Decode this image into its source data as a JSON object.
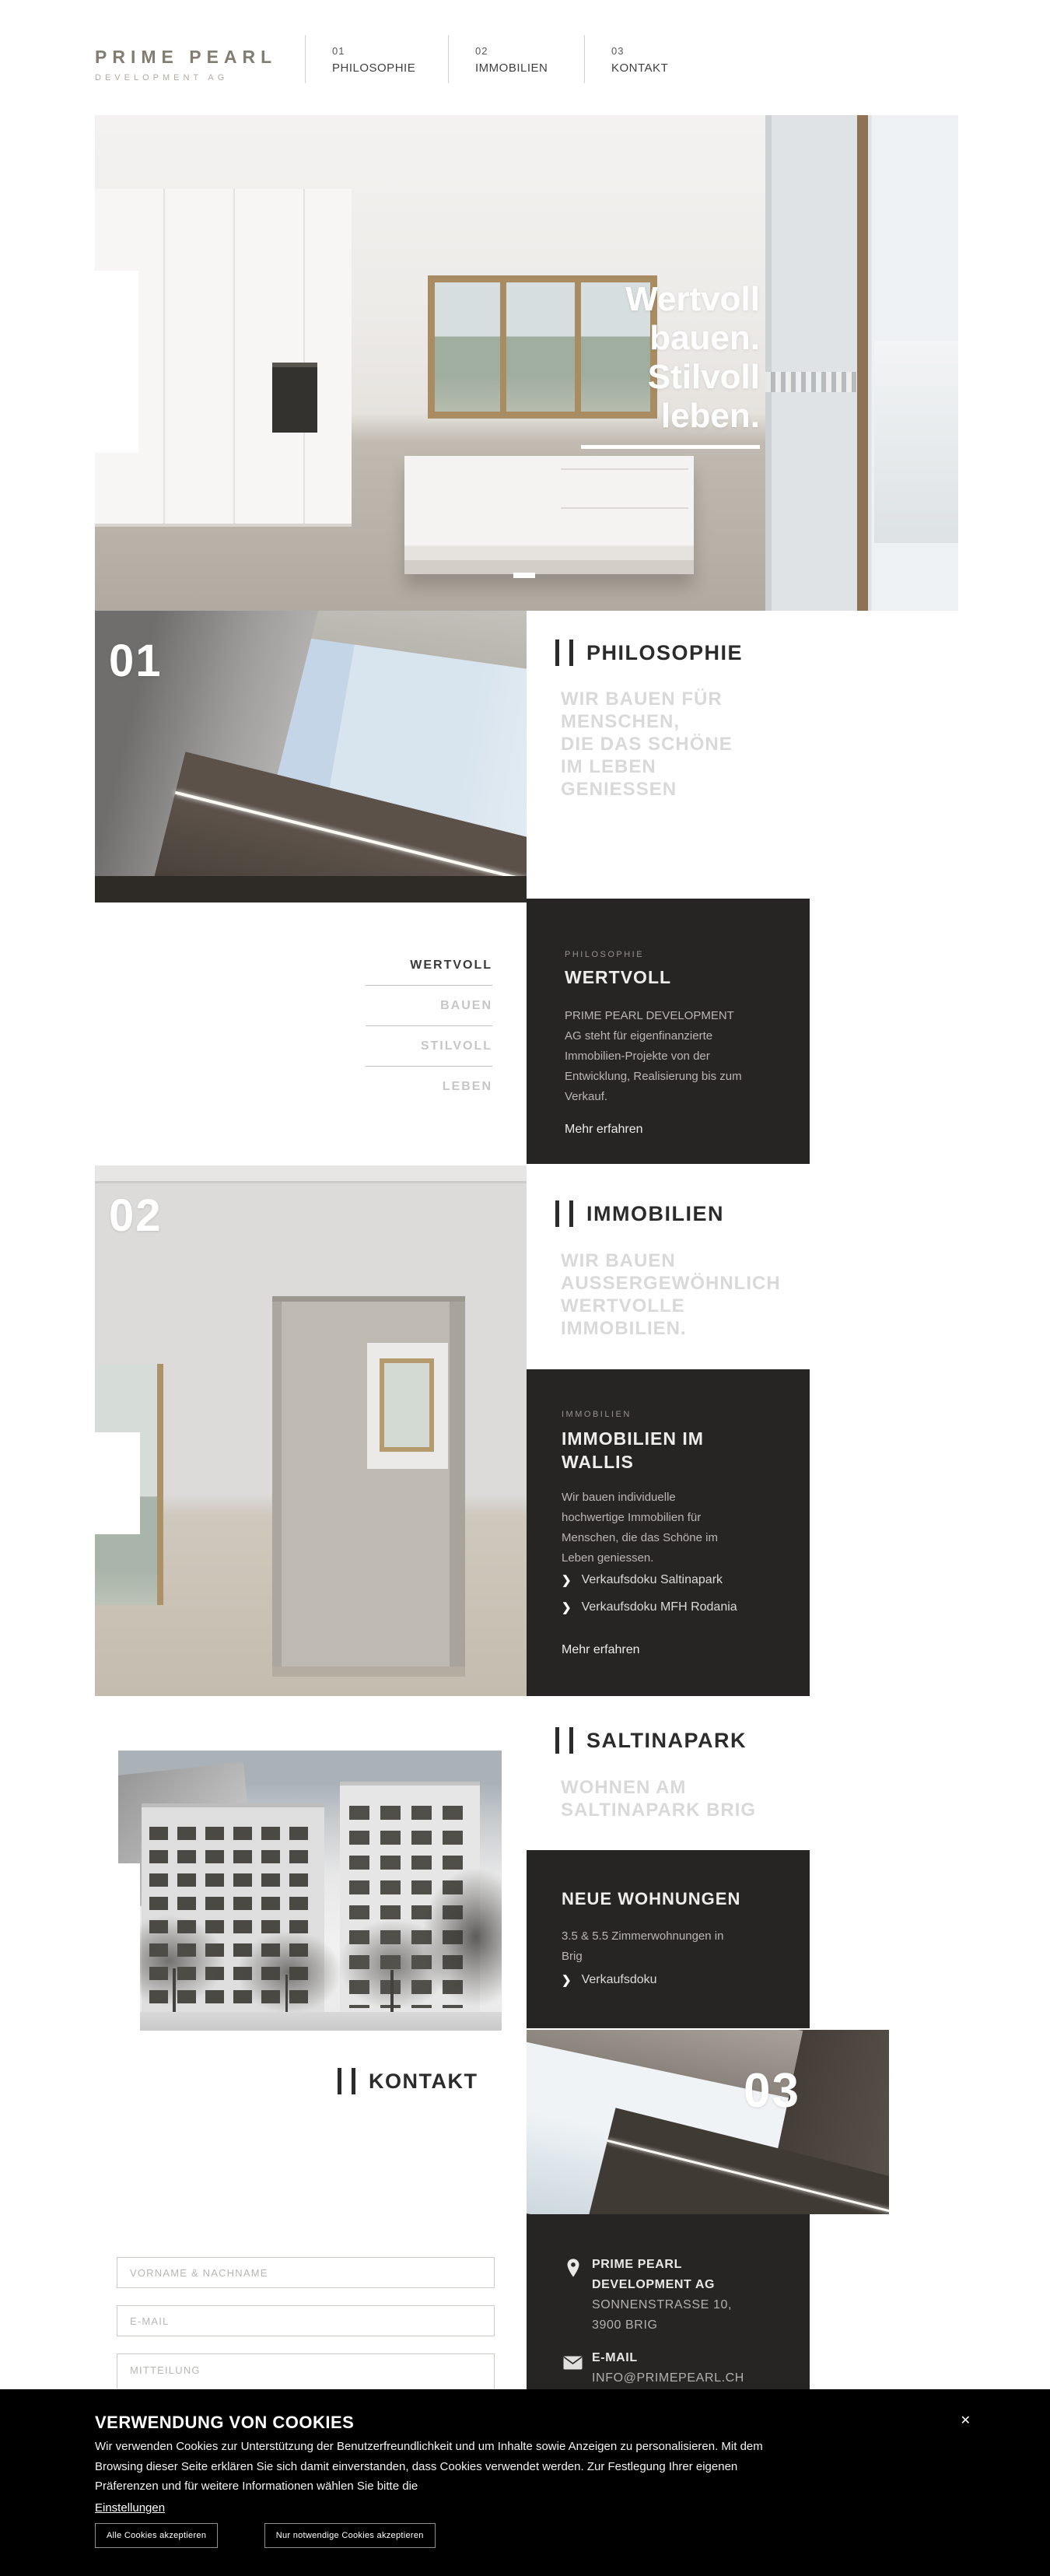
{
  "header": {
    "brand_title": "PRIME PEARL",
    "brand_subtitle": "DEVELOPMENT AG",
    "nav": [
      {
        "num": "01",
        "label": "PHILOSOPHIE"
      },
      {
        "num": "02",
        "label": "IMMOBILIEN"
      },
      {
        "num": "03",
        "label": "KONTAKT"
      }
    ]
  },
  "hero": {
    "line1": "Wertvoll",
    "line2": "bauen.",
    "line3": "Stilvoll",
    "line4": "leben."
  },
  "philosophie": {
    "number": "01",
    "heading": "PHILOSOPHIE",
    "sub1": "WIR BAUEN FÜR",
    "sub2": "MENSCHEN,",
    "sub3": "DIE DAS SCHÖNE",
    "sub4": "IM LEBEN",
    "sub5": "GENIESSEN",
    "tab1": "WERTVOLL",
    "tab2": "BAUEN",
    "tab3": "STILVOLL",
    "tab4": "LEBEN",
    "card_label": "PHILOSOPHIE",
    "card_title": "WERTVOLL",
    "card_body": "PRIME PEARL DEVELOPMENT AG steht für eigenfinanzierte Immobilien-Projekte von der Entwicklung, Realisierung bis zum Verkauf.",
    "card_link": "Mehr erfahren"
  },
  "immobilien": {
    "number": "02",
    "heading": "IMMOBILIEN",
    "sub1": "WIR BAUEN",
    "sub2": "AUSSERGEWÖHNLICH",
    "sub3": "WERTVOLLE",
    "sub4": "IMMOBILIEN.",
    "card_label": "IMMOBILIEN",
    "card_title": "IMMOBILIEN IM WALLIS",
    "card_body": "Wir bauen individuelle hochwertige Immobilien für Menschen, die das Schöne im Leben geniessen.",
    "doc_link1": "Verkaufsdoku Saltinapark",
    "doc_link2": "Verkaufsdoku MFH Rodania",
    "card_link": "Mehr erfahren"
  },
  "saltinapark": {
    "heading": "SALTINAPARK",
    "sub1": "WOHNEN AM",
    "sub2": "SALTINAPARK BRIG",
    "card_title": "NEUE WOHNUNGEN",
    "card_body": "3.5 & 5.5 Zimmerwohnungen in Brig",
    "doc_link": "Verkaufsdoku"
  },
  "kontakt": {
    "number": "03",
    "heading": "KONTAKT",
    "field1_placeholder": "VORNAME & NACHNAME",
    "field2_placeholder": "E-MAIL",
    "field3_placeholder": "MITTEILUNG",
    "company1": "PRIME PEARL",
    "company2": "DEVELOPMENT AG",
    "address1": "SONNENSTRASSE 10,",
    "address2": "3900 BRIG",
    "email_label": "E-MAIL",
    "email_value": "INFO@PRIMEPEARL.CH"
  },
  "cookies": {
    "title": "VERWENDUNG VON COOKIES",
    "close": "✕",
    "body": "Wir verwenden Cookies zur Unterstützung der Benutzerfreundlichkeit und um Inhalte sowie Anzeigen zu personalisieren. Mit dem Browsing dieser Seite erklären Sie sich damit einverstanden, dass Cookies verwendet werden. Zur Festlegung Ihrer eigenen Präferenzen und für weitere Informationen wählen Sie bitte die",
    "settings": "Einstellungen",
    "btn_accept_all": "Alle Cookies akzeptieren",
    "btn_accept_necessary": "Nur notwendige Cookies akzeptieren"
  },
  "colors": {
    "dark_card": "#272524",
    "banner": "#000000",
    "subtitle_gray": "#d9d9d9"
  }
}
